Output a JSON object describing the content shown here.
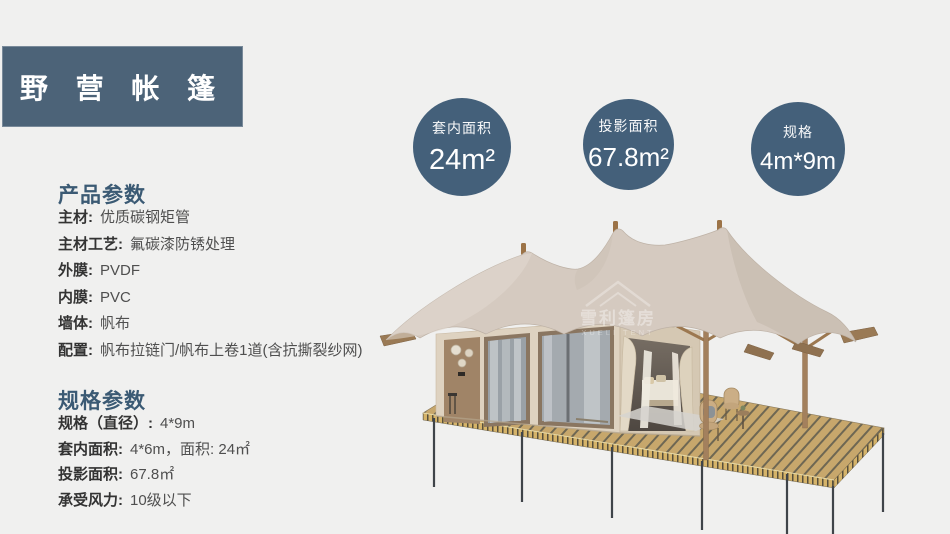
{
  "title_banner": {
    "text": "野 营 帐 篷"
  },
  "stat_circles": [
    {
      "label": "套内面积",
      "value": "24m²"
    },
    {
      "label": "投影面积",
      "value": "67.8m²"
    },
    {
      "label": "规格",
      "value": "4m*9m"
    }
  ],
  "product_params": {
    "heading": "产品参数",
    "rows": [
      {
        "label": "主材:",
        "value": "优质碳钢矩管"
      },
      {
        "label": "主材工艺:",
        "value": "氟碳漆防锈处理"
      },
      {
        "label": "外膜:",
        "value": "PVDF"
      },
      {
        "label": "内膜:",
        "value": "PVC"
      },
      {
        "label": "墙体:",
        "value": "帆布"
      },
      {
        "label": "配置:",
        "value": "帆布拉链门/帆布上卷1道(含抗撕裂纱网)"
      }
    ]
  },
  "spec_params": {
    "heading": "规格参数",
    "rows": [
      {
        "label": "规格（直径）:",
        "value": "4*9m"
      },
      {
        "label": "套内面积:",
        "value": "4*6m，面积: 24㎡"
      },
      {
        "label": "投影面积:",
        "value": "67.8㎡"
      },
      {
        "label": "承受风力:",
        "value": "10级以下"
      }
    ]
  },
  "tent_image": {
    "watermark_cn": "雪利篷房",
    "watermark_en": "XUELI TENT"
  },
  "colors": {
    "brand_slate": "#4c6378",
    "circle_slate": "#44607a",
    "roof_beige": "#d5cac0",
    "cabin_wall": "#ded2c0",
    "deck_wood": "#c7a76c",
    "background": "#f0f0ef"
  }
}
